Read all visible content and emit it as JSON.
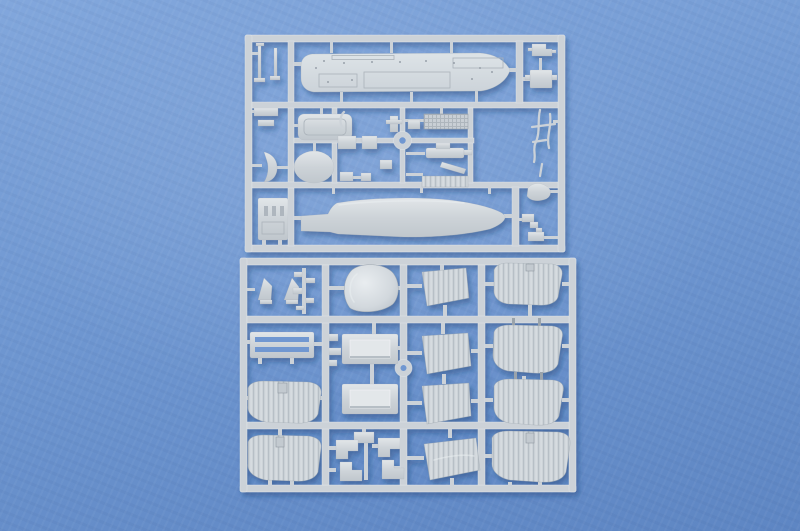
{
  "scene": {
    "type": "photograph",
    "description": "Top-down product photo of two light-gray injection-molded polystyrene sprues (part runners) of a ship model kit lying on a plain blue textured backdrop. No text is visible in the image.",
    "background": "plain blue paper backdrop with soft lighting, slightly lighter at upper area and darker toward the bottom",
    "objects": [
      {
        "name": "sprue-a-upper",
        "description": "Upper rectangular sprue frame holding the ship main deck (top cell), a smooth lower-hull half (bottom cell), and a middle band of small parts",
        "parts": [
          "main-deck",
          "lower-hull-half",
          "cabin-roof-rounded-rect",
          "boat-oval",
          "grating-panel",
          "gun-mount",
          "ribbed-strip",
          "superstructure-block",
          "davits",
          "crescent-part",
          "masts-antennas",
          "top-fitting",
          "fitting-box",
          "anchor-blob",
          "small-brackets",
          "round-gate-ring"
        ]
      },
      {
        "name": "sprue-b-lower",
        "description": "Lower rectangular sprue frame in a 4x4 grid holding curved ribbed hull/deck panels in the outer columns, trapezoid ribbed panels, beveled hatch panels, a rounded hull dome, a ladder/vent frame, fin-shaped bits and C-shaped brackets",
        "parts": [
          "hull-dome",
          "fin-parts",
          "mini-runner-cluster",
          "trapezoid-panel-1",
          "ribbed-panel-top-right",
          "ladder-vent-panel",
          "beveled-hatch-1",
          "trapezoid-panel-2",
          "ribbed-panel-right-2",
          "ribbed-panel-left-3",
          "beveled-hatch-2",
          "trapezoid-panel-3",
          "ribbed-panel-right-3",
          "ribbed-panel-left-4",
          "c-brackets",
          "trapezoid-panel-4",
          "ribbed-panel-right-4",
          "round-gate-ring"
        ]
      }
    ],
    "material": "light gray styrene plastic",
    "lighting": "soft diffuse light from upper left, sprues cast a soft blue-violet shadow down-right onto the backdrop"
  },
  "colors": {
    "background_top": "#82a7dc",
    "background_mid": "#6f97d1",
    "background_bottom": "#5e86c3",
    "plastic_base": "#ccd2d8",
    "plastic_light": "#e4e8eb",
    "plastic_dark": "#b2bac2",
    "plastic_deck": "#d6dce0",
    "shadow": "#1f3a6e"
  }
}
